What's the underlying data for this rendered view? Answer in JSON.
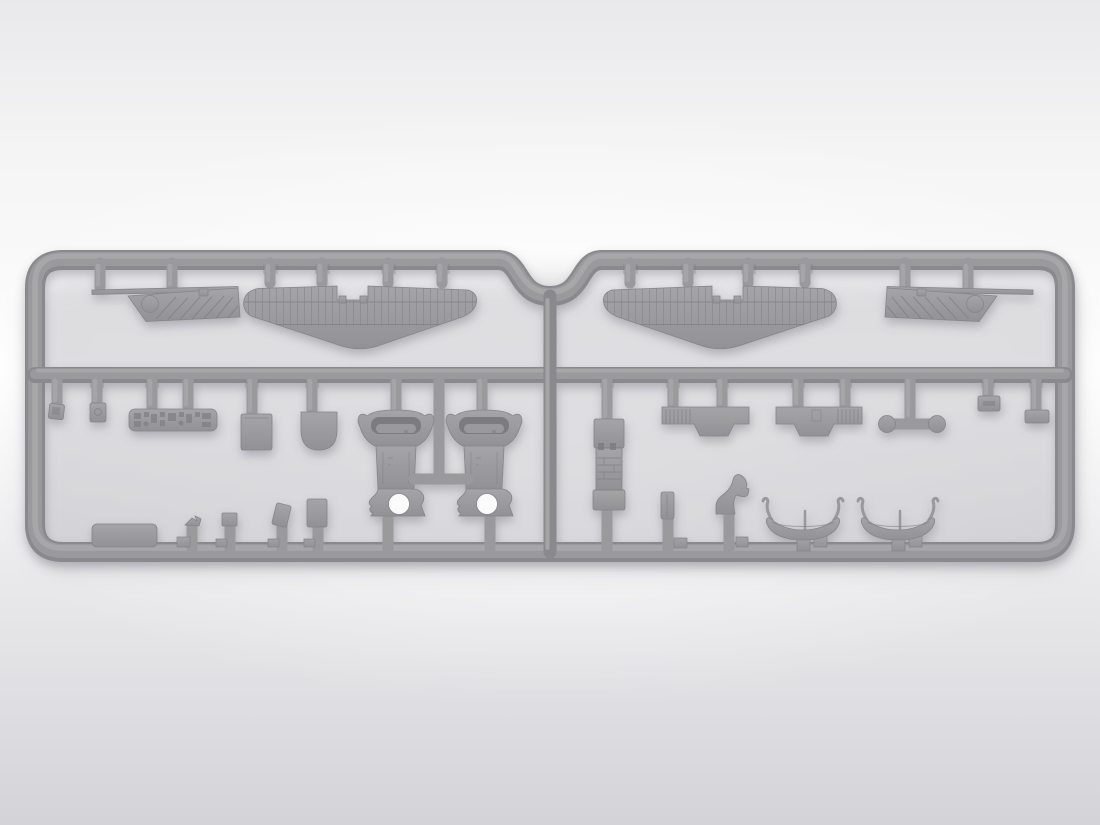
{
  "scene": {
    "subject": "gray injection-molded model kit sprue with aircraft parts on studio gradient background",
    "render_style": "soft-shadow 3d product render",
    "visible_text": "none"
  },
  "colors": {
    "bg_top": "#e9e9eb",
    "bg_upper": "#f5f5f6",
    "bg_mid": "#fefefe",
    "bg_lower": "#ececee",
    "bg_bottom": "#d4d4d8",
    "plastic": "#99999c",
    "plastic_light": "#a9a9ac",
    "plastic_dark": "#85858a",
    "rail_base": "#8a8a8e",
    "rail_mid": "#9a9a9d",
    "recess": "#7c7c80",
    "detail": "#7f7f83",
    "hole": "#fbfbfc",
    "shadow": "#83838d"
  },
  "sprue": {
    "halves": 2,
    "rows": 2,
    "material": "light gray styrene",
    "parts_inventory": [
      {
        "name": "corrugated-wing-panel",
        "count": 2
      },
      {
        "name": "stabilizer-panel",
        "count": 2
      },
      {
        "name": "engine-cowling-front",
        "count": 2
      },
      {
        "name": "instrument-panel",
        "count": 1
      },
      {
        "name": "bulkhead-square",
        "count": 1
      },
      {
        "name": "bulkhead-rounded",
        "count": 1
      },
      {
        "name": "cockpit-floor-column",
        "count": 1
      },
      {
        "name": "wing-center-section",
        "count": 2
      },
      {
        "name": "control-yoke-with-wheels",
        "count": 1
      },
      {
        "name": "float-hull",
        "count": 2
      },
      {
        "name": "small-fitting",
        "count": 11
      }
    ]
  }
}
